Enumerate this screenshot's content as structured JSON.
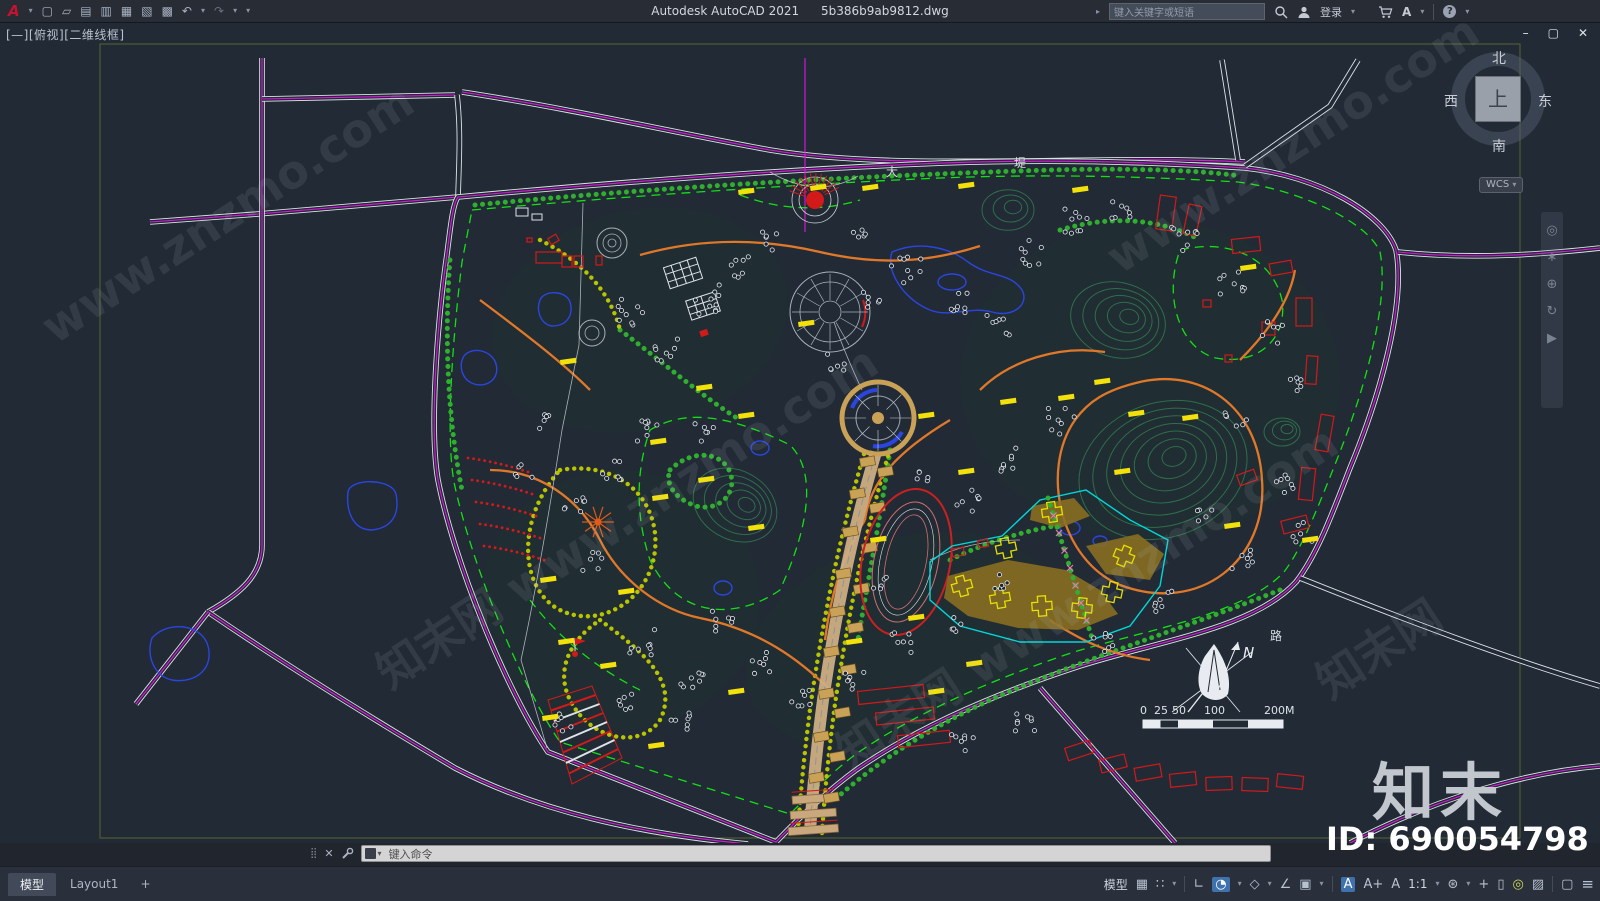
{
  "window": {
    "app_title": "Autodesk AutoCAD 2021",
    "doc_title": "5b386b9ab9812.dwg",
    "search_placeholder": "键入关键字或短语",
    "sign_in_label": "登录",
    "autodesk_mark": "A",
    "help_mark": "?",
    "minimize_glyph": "–",
    "maximize_glyph": "▢",
    "close_glyph": "✕"
  },
  "ui": {
    "caret": "▾",
    "expand": "▸"
  },
  "quick_access": {
    "logo": "A",
    "items": [
      {
        "name": "new",
        "glyph": "▢"
      },
      {
        "name": "open",
        "glyph": "▱"
      },
      {
        "name": "save",
        "glyph": "▤"
      },
      {
        "name": "save-as",
        "glyph": "▥"
      },
      {
        "name": "plot",
        "glyph": "▦"
      },
      {
        "name": "publish",
        "glyph": "▧"
      },
      {
        "name": "print",
        "glyph": "▩"
      },
      {
        "name": "undo",
        "glyph": "↶"
      },
      {
        "name": "redo",
        "glyph": "↷"
      }
    ]
  },
  "viewport_label": "[—][俯视][二维线框]",
  "viewcube": {
    "top": "上",
    "north": "北",
    "south": "南",
    "west": "西",
    "east": "东",
    "wcs_label": "WCS"
  },
  "navbar": {
    "items": [
      {
        "name": "navigation-wheel",
        "glyph": "◎"
      },
      {
        "name": "pan",
        "glyph": "∗"
      },
      {
        "name": "zoom",
        "glyph": "⊕"
      },
      {
        "name": "orbit",
        "glyph": "↻"
      },
      {
        "name": "showmotion",
        "glyph": "▶"
      }
    ]
  },
  "drawing": {
    "road_labels": [
      "大",
      "堤",
      "路"
    ],
    "north_label": "N",
    "scale_ticks": [
      "0",
      "25",
      "50",
      "100",
      "200M"
    ],
    "watermarks": [
      "www.znzmo.com",
      "知末网 www.znzmo.com",
      "知末网 www.znzmo.com",
      "www.znzmo.com",
      "知末网"
    ]
  },
  "overlay": {
    "brand": "知末",
    "id_label": "ID: 690054798"
  },
  "command_line": {
    "placeholder": "键入命令",
    "close_glyph": "✕",
    "grip_glyph": "⣿"
  },
  "layout_tabs": {
    "model": "模型",
    "layout1": "Layout1",
    "add": "+"
  },
  "status_bar": {
    "model_label": "模型",
    "menu_glyph": "≡",
    "items": [
      {
        "name": "grid",
        "glyph": "▦"
      },
      {
        "name": "snap",
        "glyph": "∷"
      },
      {
        "name": "ortho",
        "glyph": "∟"
      },
      {
        "name": "polar-tracking",
        "glyph": "◔"
      },
      {
        "name": "isodraft",
        "glyph": "◇"
      },
      {
        "name": "object-snap-tracking",
        "glyph": "∠"
      },
      {
        "name": "object-snap",
        "glyph": "▣"
      },
      {
        "name": "annotation-visibility",
        "glyph": "A"
      },
      {
        "name": "annotation-autoscale",
        "glyph": "A+"
      },
      {
        "name": "annotation-scale",
        "glyph": "A"
      },
      {
        "name": "scale-value",
        "glyph": "1:1"
      },
      {
        "name": "workspace",
        "glyph": "⊛"
      },
      {
        "name": "annotation-monitor",
        "glyph": "+"
      },
      {
        "name": "quick-properties",
        "glyph": "▯"
      },
      {
        "name": "isolate-objects",
        "glyph": "◎"
      },
      {
        "name": "graphics-performance",
        "glyph": "▨"
      },
      {
        "name": "clean-screen",
        "glyph": "▢"
      }
    ]
  }
}
